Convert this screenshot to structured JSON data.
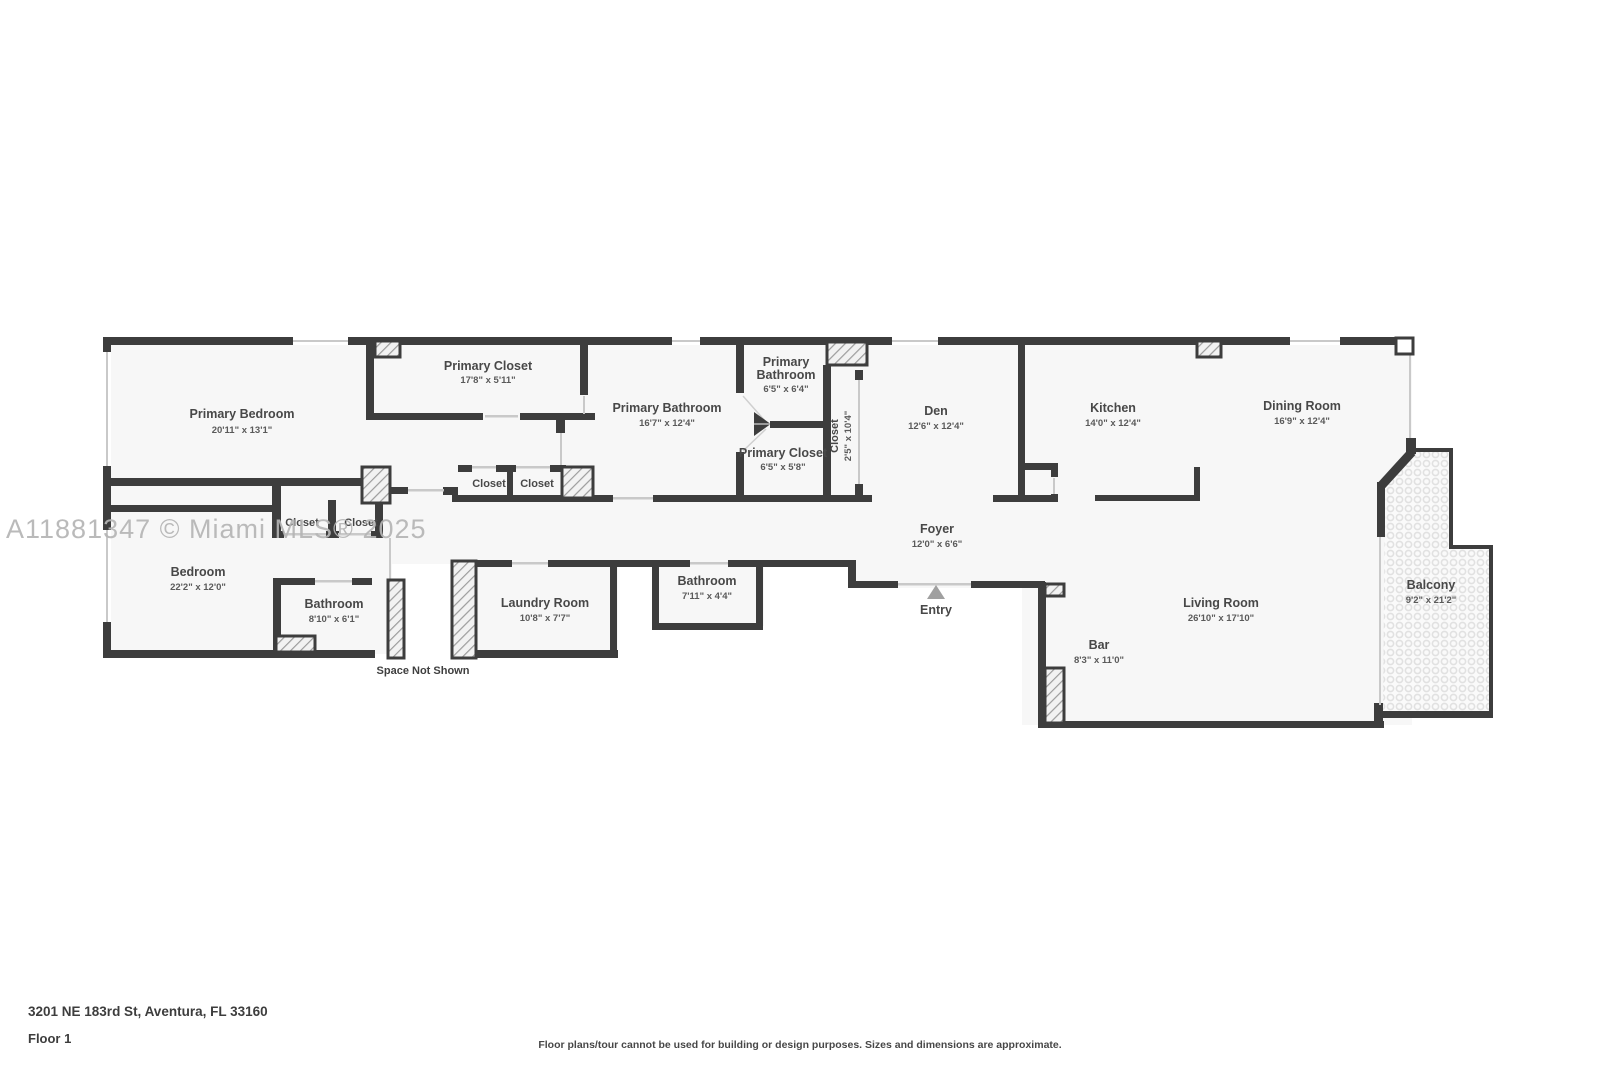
{
  "watermark": "A11881347 © Miami MLS® 2025",
  "footer": {
    "address": "3201 NE 183rd St, Aventura, FL 33160",
    "floor": "Floor 1",
    "disclaimer": "Floor plans/tour cannot be used for building or design purposes. Sizes and dimensions are approximate."
  },
  "rooms": {
    "primary_bedroom": {
      "label": "Primary Bedroom",
      "dims": "20'11\" x 13'1\""
    },
    "primary_closet": {
      "label": "Primary Closet",
      "dims": "17'8\" x 5'11\""
    },
    "primary_bathroom": {
      "label": "Primary Bathroom",
      "dims": "16'7\" x 12'4\""
    },
    "primary_bathroom_small": {
      "line1": "Primary",
      "line2": "Bathroom",
      "dims": "6'5\" x 6'4\""
    },
    "primary_closet_small": {
      "label": "Primary Closet",
      "dims": "6'5\" x 5'8\""
    },
    "closet_tall": {
      "label": "Closet",
      "dims": "2'5\" x 10'4\""
    },
    "den": {
      "label": "Den",
      "dims": "12'6\" x 12'4\""
    },
    "kitchen": {
      "label": "Kitchen",
      "dims": "14'0\" x 12'4\""
    },
    "dining_room": {
      "label": "Dining Room",
      "dims": "16'9\" x 12'4\""
    },
    "living_room": {
      "label": "Living Room",
      "dims": "26'10\" x 17'10\""
    },
    "balcony": {
      "label": "Balcony",
      "dims": "9'2\" x 21'2\""
    },
    "bar": {
      "label": "Bar",
      "dims": "8'3\" x 11'0\""
    },
    "foyer": {
      "label": "Foyer",
      "dims": "12'0\" x 6'6\""
    },
    "entry": {
      "label": "Entry"
    },
    "laundry_room": {
      "label": "Laundry Room",
      "dims": "10'8\" x 7'7\""
    },
    "bathroom_mid": {
      "label": "Bathroom",
      "dims": "7'11\" x 4'4\""
    },
    "bathroom_left": {
      "label": "Bathroom",
      "dims": "8'10\" x 6'1\""
    },
    "bedroom": {
      "label": "Bedroom",
      "dims": "22'2\" x 12'0\""
    },
    "closet_hall_1": {
      "label": "Closet"
    },
    "closet_hall_2": {
      "label": "Closet"
    },
    "closet_bed_1": {
      "label": "Closet"
    },
    "closet_bed_2": {
      "label": "Closet"
    },
    "space_not_shown": {
      "label": "Space Not Shown"
    }
  }
}
